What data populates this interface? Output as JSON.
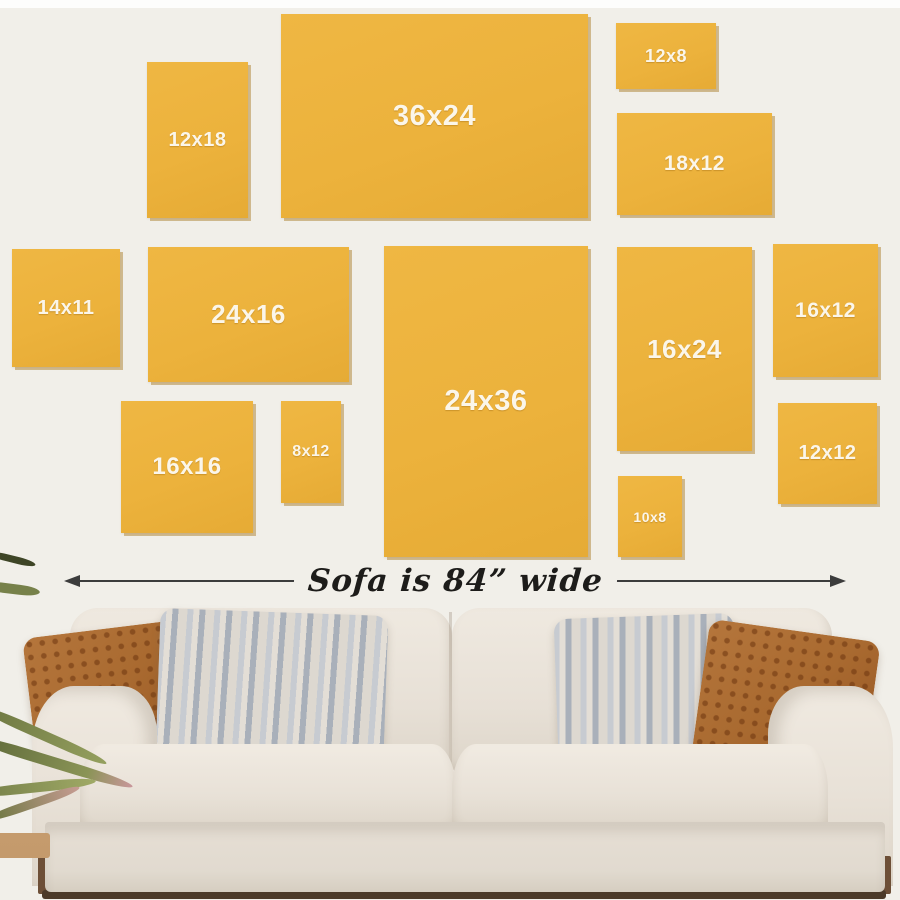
{
  "scene": {
    "title": "Canvas size guide above sofa",
    "wall_color": "#f1efe9",
    "canvas_color": "#ecb23c",
    "canvas_label_color": "#fbf6ea",
    "arrow_color": "#3c3c3c"
  },
  "canvases": [
    {
      "label": "12x18"
    },
    {
      "label": "36x24"
    },
    {
      "label": "12x8"
    },
    {
      "label": "18x12"
    },
    {
      "label": "14x11"
    },
    {
      "label": "24x16"
    },
    {
      "label": "24x36"
    },
    {
      "label": "16x24"
    },
    {
      "label": "16x12"
    },
    {
      "label": "16x16"
    },
    {
      "label": "8x12"
    },
    {
      "label": "10x8"
    },
    {
      "label": "12x12"
    }
  ],
  "annotation": {
    "sofa_width_label": "Sofa is 84” wide"
  }
}
